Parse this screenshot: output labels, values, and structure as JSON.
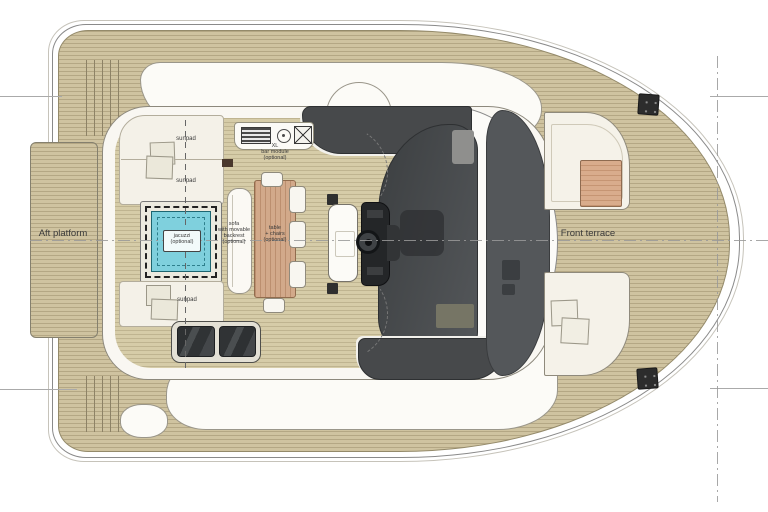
{
  "plan": {
    "labels": {
      "aft_platform": "Aft platform",
      "front_terrace": "Front terrace"
    },
    "flybridge": {
      "sunpads": [
        "sunpad",
        "sunpad",
        "sunpad"
      ],
      "jacuzzi_label": "jacuzzi\n(optional)",
      "sofa_label": "sofa\nwith movable\nbackrest\n(optional)",
      "table_label": "table\n+ chairs\n(optional)",
      "bar_label": "XL\nbar module\n(optional)"
    },
    "icons": [
      "grille-icon",
      "sink-icon",
      "grill-icon",
      "steering-wheel-icon",
      "cleat-icon",
      "skylight-glass",
      "jacuzzi"
    ],
    "colors": {
      "deck_wood": "#cfc3a0",
      "flybridge_wood": "#d6cca8",
      "table_wood": "#d2a98a",
      "jacuzzi_water": "#7fd0dd",
      "tinted_glass": "#47494b",
      "hull_white": "#fcfbf7"
    }
  }
}
